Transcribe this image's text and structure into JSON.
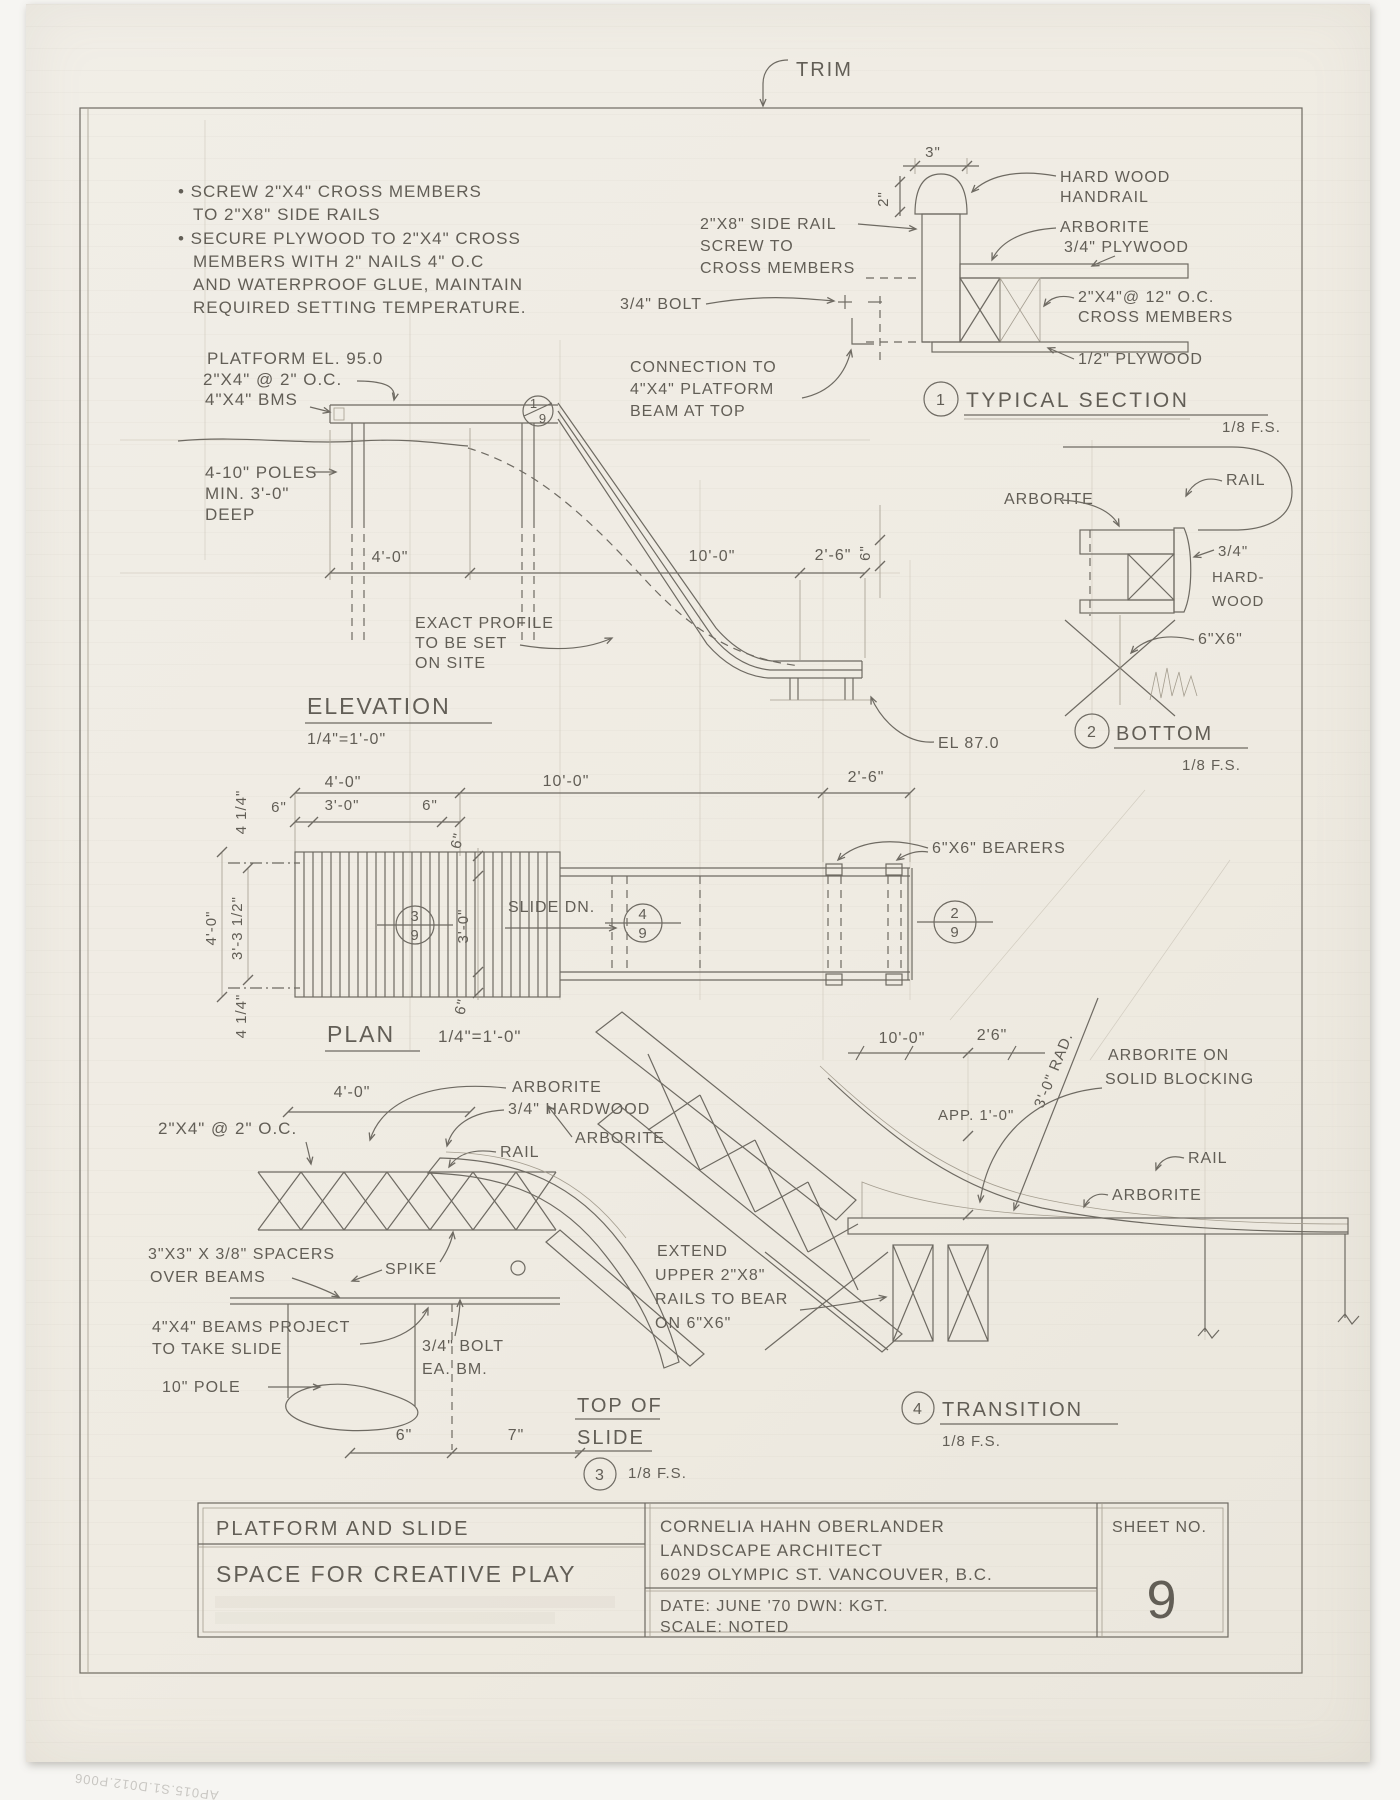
{
  "sheet": {
    "trim": "TRIM",
    "archive_note": "AP015.S1.D012.P006",
    "notes": [
      "• SCREW 2\"X4\" CROSS MEMBERS",
      "TO 2\"X8\" SIDE RAILS",
      "• SECURE PLYWOOD TO 2\"X4\" CROSS",
      "MEMBERS WITH 2\" NAILS 4\" O.C",
      "AND WATERPROOF GLUE, MAINTAIN",
      "REQUIRED SETTING TEMPERATURE."
    ]
  },
  "typical_section": {
    "number": "1",
    "title": "TYPICAL SECTION",
    "scale": "1/8 F.S.",
    "dim_3": "3\"",
    "dim_2": "2\"",
    "hardwood": [
      "HARD WOOD",
      "HANDRAIL"
    ],
    "arborite": "ARBORITE",
    "plywood34": "3/4\" PLYWOOD",
    "siderail": [
      "2\"X8\" SIDE RAIL",
      "SCREW TO",
      "CROSS MEMBERS"
    ],
    "bolt": "3/4\" BOLT",
    "crossmembers": [
      "2\"X4\"@ 12\" O.C.",
      "CROSS MEMBERS"
    ],
    "plywood12": "1/2\" PLYWOOD",
    "connection": [
      "CONNECTION TO",
      "4\"X4\" PLATFORM",
      "BEAM AT TOP"
    ]
  },
  "bottom": {
    "number": "2",
    "title": "BOTTOM",
    "scale": "1/8 F.S.",
    "arborite": "ARBORITE",
    "rail": "RAIL",
    "hardwood": [
      "3/4\"",
      "HARD-",
      "WOOD"
    ],
    "post": "6\"X6\""
  },
  "elevation": {
    "title": "ELEVATION",
    "scale": "1/4\"=1'-0\"",
    "platform_el": "PLATFORM EL. 95.0",
    "cross": "2\"X4\" @ 2\" O.C.",
    "beams": "4\"X4\" BMS",
    "poles": [
      "4-10\" POLES",
      "MIN. 3'-0\"",
      "DEEP"
    ],
    "profile": [
      "EXACT PROFILE",
      "TO BE SET",
      "ON SITE"
    ],
    "el_bottom": "EL 87.0",
    "end_dim": "6\"",
    "dims": [
      "4'-0\"",
      "10'-0\"",
      "2'-6\""
    ],
    "marker_top": "1",
    "marker_bottom": "9"
  },
  "plan": {
    "title": "PLAN",
    "scale": "1/4\"=1'-0\"",
    "dims_top": [
      "4'-0\"",
      "10'-0\"",
      "2'-6\""
    ],
    "dims_sub": [
      "6\"",
      "3'-0\"",
      "6\""
    ],
    "dims_left": [
      "4 1/4\"",
      "4'-0\"",
      "3'-3 1/2\"",
      "4 1/4\""
    ],
    "dims_inner": [
      "6\"",
      "3'-0\"",
      "6\""
    ],
    "slide_dn": "SLIDE DN.",
    "bearers": "6\"X6\" BEARERS",
    "m3_top": "3",
    "m3_bottom": "9",
    "m4_top": "4",
    "m4_bottom": "9",
    "m2_top": "2",
    "m2_bottom": "9"
  },
  "top_of_slide": {
    "number": "3",
    "title": [
      "TOP OF",
      "SLIDE"
    ],
    "scale": "1/8 F.S.",
    "dim_w": "4'-0\"",
    "dim_6": "6\"",
    "dim_7": "7\"",
    "cross": "2\"X4\" @ 2\" O.C.",
    "arborite": "ARBORITE",
    "hardwood": "3/4\" HARDWOOD",
    "rail": "RAIL",
    "spacers": [
      "3\"X3\" X 3/8\" SPACERS",
      "OVER BEAMS"
    ],
    "spike": "SPIKE",
    "beams": [
      "4\"X4\" BEAMS PROJECT",
      "TO TAKE SLIDE"
    ],
    "pole": "10\" POLE",
    "bolt": [
      "3/4\" BOLT",
      "EA. BM."
    ],
    "arborite2": "ARBORITE"
  },
  "transition": {
    "number": "4",
    "title": "TRANSITION",
    "scale": "1/8 F.S.",
    "dim_10": "10'-0\"",
    "dim_26": "2'6\"",
    "radius": "3'-0\" RAD.",
    "approx": "APP. 1'-0\"",
    "blocking": [
      "ARBORITE ON",
      "SOLID BLOCKING"
    ],
    "rail": "RAIL",
    "arborite": "ARBORITE",
    "extend": [
      "EXTEND",
      "UPPER 2\"X8\"",
      "RAILS TO BEAR",
      "ON 6\"X6\""
    ]
  },
  "title_block": {
    "project": "PLATFORM AND SLIDE",
    "subtitle": "SPACE FOR CREATIVE PLAY",
    "firm": [
      "CORNELIA HAHN OBERLANDER",
      "LANDSCAPE ARCHITECT",
      "6029 OLYMPIC ST. VANCOUVER, B.C."
    ],
    "date_line": "DATE: JUNE '70   DWN: KGT.",
    "scale_line": "SCALE: NOTED",
    "sheet_label": "SHEET NO.",
    "sheet_number": "9"
  }
}
